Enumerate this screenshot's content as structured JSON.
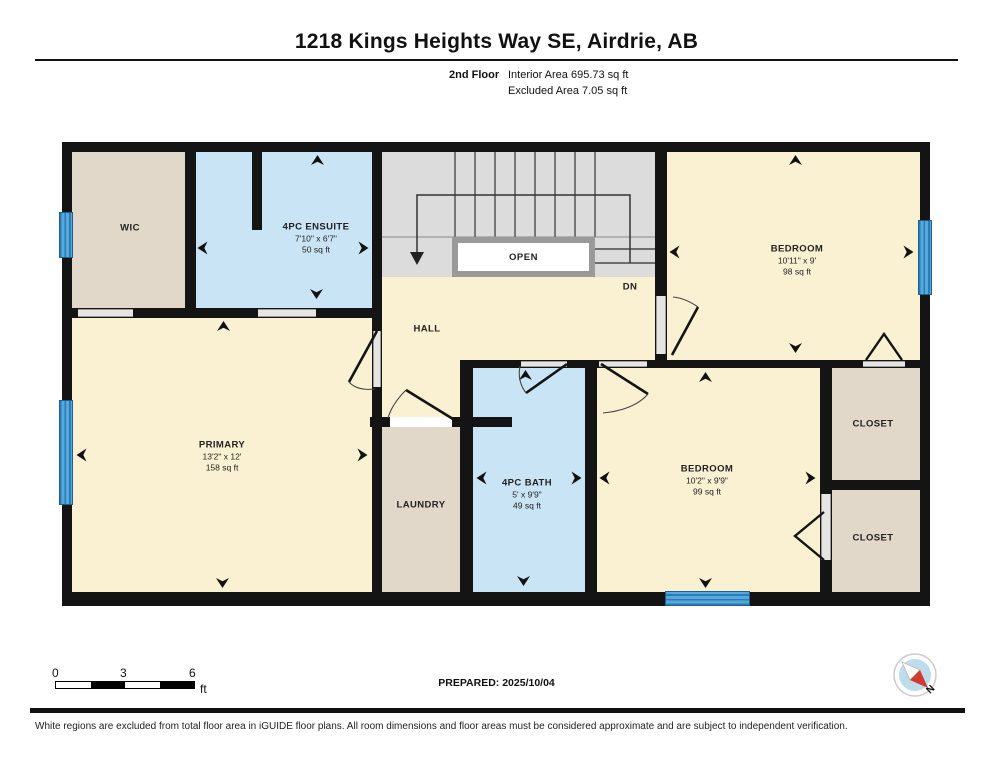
{
  "header": {
    "title": "1218 Kings Heights Way SE, Airdrie, AB",
    "floor_label": "2nd Floor",
    "interior_area": "Interior Area 695.73 sq ft",
    "excluded_area": "Excluded Area 7.05 sq ft"
  },
  "rooms": {
    "wic": {
      "name": "WIC"
    },
    "ensuite": {
      "name": "4PC ENSUITE",
      "dims": "7'10\" x 6'7\"",
      "area": "50 sq ft"
    },
    "bedroom_top": {
      "name": "BEDROOM",
      "dims": "10'11\" x 9'",
      "area": "98 sq ft"
    },
    "primary": {
      "name": "PRIMARY",
      "dims": "13'2\" x 12'",
      "area": "158 sq ft"
    },
    "hall": {
      "name": "HALL"
    },
    "laundry": {
      "name": "LAUNDRY"
    },
    "bath": {
      "name": "4PC BATH",
      "dims": "5' x 9'9\"",
      "area": "49 sq ft"
    },
    "bedroom_bottom": {
      "name": "BEDROOM",
      "dims": "10'2\" x 9'9\"",
      "area": "99 sq ft"
    },
    "closet_top": {
      "name": "CLOSET"
    },
    "closet_bottom": {
      "name": "CLOSET"
    }
  },
  "stairs": {
    "open_label": "OPEN",
    "down_label": "DN"
  },
  "scale_bar": {
    "ticks": [
      "0",
      "3",
      "6"
    ],
    "unit": "ft"
  },
  "footer": {
    "prepared": "PREPARED: 2025/10/04",
    "disclaimer": "White regions are excluded from total floor area in iGUIDE floor plans. All room dimensions and floor areas must be considered approximate and are subject to independent verification.",
    "compass_label": "N"
  },
  "colors": {
    "wall": "#141414",
    "room_yellow": "#FAF0D2",
    "room_blue": "#C9E4F5",
    "room_tan": "#E1D8C9",
    "stair_gray": "#DCDCDC",
    "window_blue": "#4D9FD6",
    "compass_red": "#D23B2F",
    "compass_blue": "#BFDCEC"
  }
}
